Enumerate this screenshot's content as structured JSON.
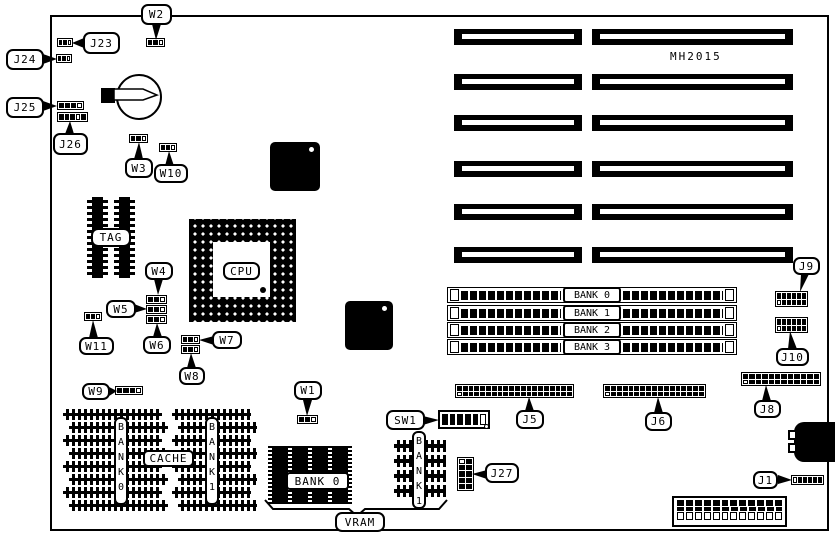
{
  "board": {
    "part_number": "MH2015"
  },
  "labels": {
    "w1": "W1",
    "w2": "W2",
    "w3": "W3",
    "w4": "W4",
    "w5": "W5",
    "w6": "W6",
    "w7": "W7",
    "w8": "W8",
    "w9": "W9",
    "w10": "W10",
    "w11": "W11",
    "j1": "J1",
    "j5": "J5",
    "j6": "J6",
    "j8": "J8",
    "j9": "J9",
    "j10": "J10",
    "j23": "J23",
    "j24": "J24",
    "j25": "J25",
    "j26": "J26",
    "j27": "J27",
    "sw1": "SW1",
    "cpu": "CPU",
    "tag": "TAG",
    "cache": "CACHE",
    "vram": "VRAM"
  },
  "simm_banks": [
    "BANK 0",
    "BANK 1",
    "BANK 2",
    "BANK 3"
  ],
  "cache_banks": [
    "BANK0",
    "BANK1"
  ],
  "vram_bank_labels": [
    "BANK 0",
    "BANK1"
  ]
}
